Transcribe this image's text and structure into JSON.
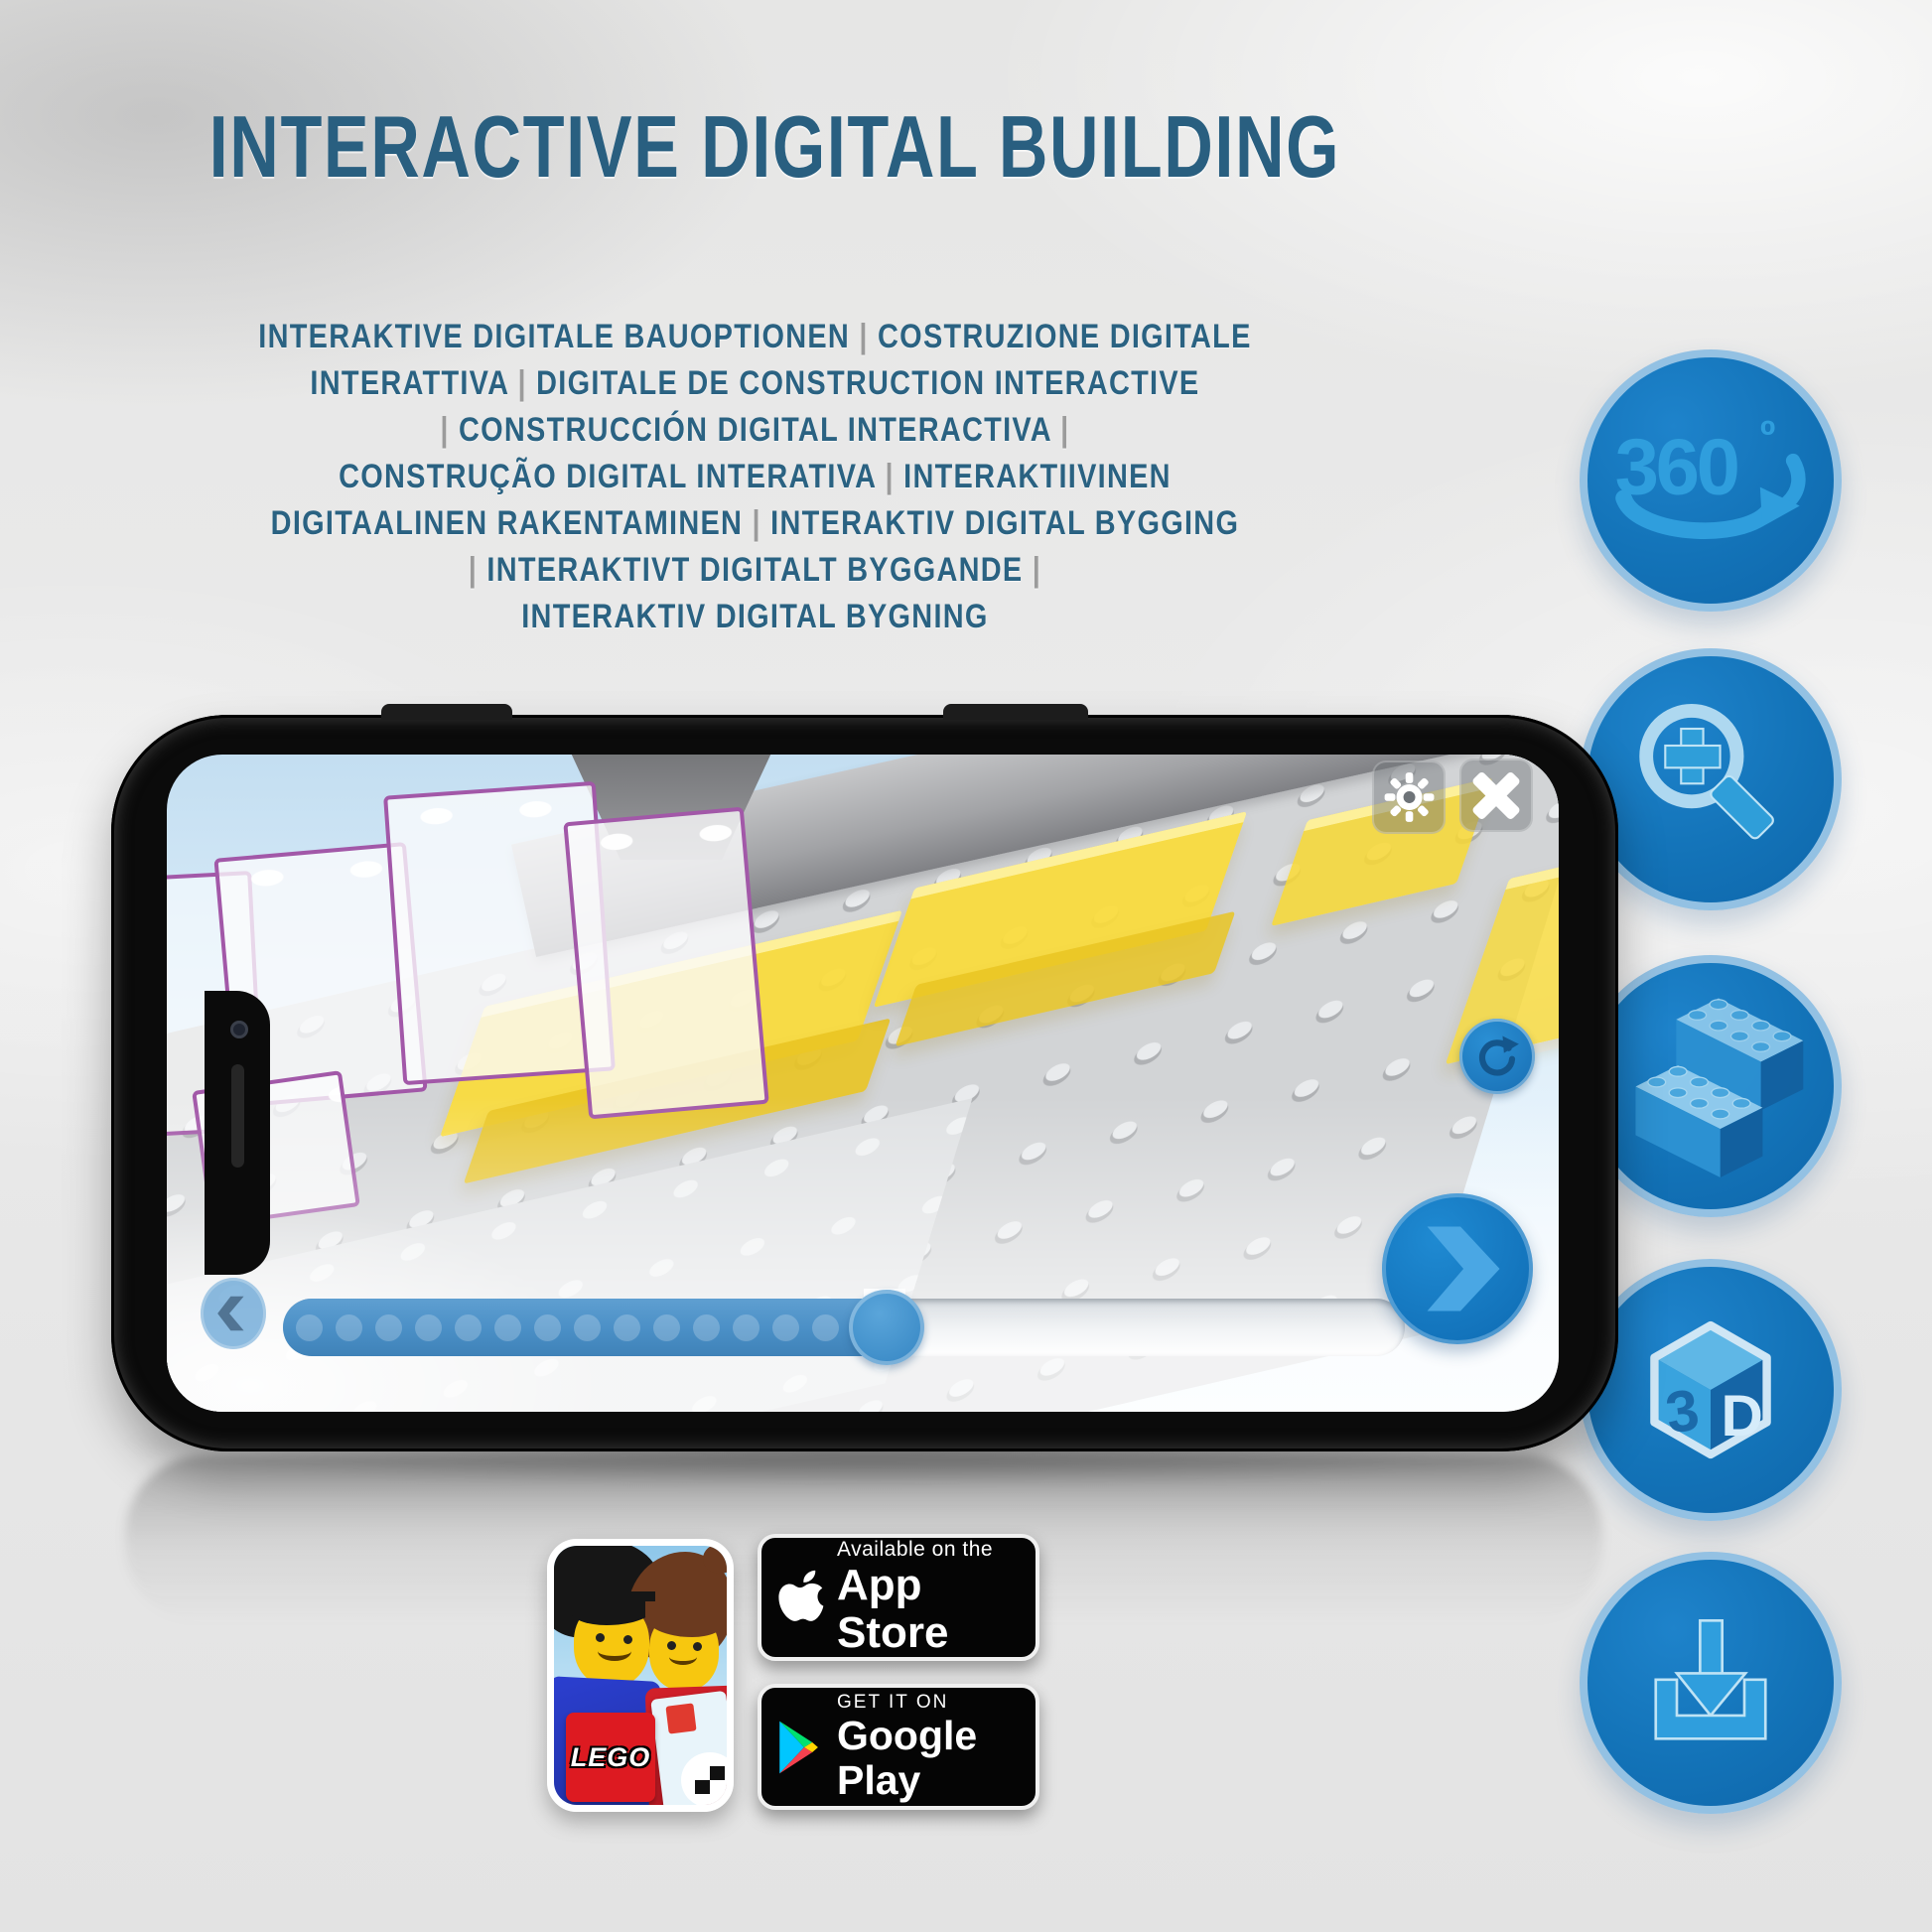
{
  "header": {
    "title": "INTERACTIVE DIGITAL BUILDING"
  },
  "subtitle": {
    "lines": [
      "INTERAKTIVE DIGITALE BAUOPTIONEN | COSTRUZIONE DIGITALE",
      "INTERATTIVA | DIGITALE DE CONSTRUCTION INTERACTIVE",
      "| CONSTRUCCIÓN DIGITAL INTERACTIVA |",
      "CONSTRUÇÃO DIGITAL INTERATIVA | INTERAKTIIVINEN",
      "DIGITAALINEN RAKENTAMINEN | INTERAKTIV DIGITAL BYGGING",
      "| INTERAKTIVT DIGITALT BYGGANDE |",
      "INTERAKTIV DIGITAL BYGNING"
    ]
  },
  "feature_icons": {
    "rotate360": {
      "label": "360",
      "degree_symbol": "º"
    },
    "cube3d": {
      "left_face": "3",
      "right_face": "D"
    }
  },
  "phone": {
    "app_ui": {
      "bookmark_star_glyph": "★"
    },
    "scene": {
      "stud_embossing": "LEGO"
    }
  },
  "store": {
    "app_icon": {
      "lego_logo": "LEGO"
    },
    "app_store": {
      "line1": "Available on the",
      "line2": "App Store"
    },
    "google_play": {
      "line1": "GET IT ON",
      "line2": "Google Play"
    }
  },
  "colors": {
    "title_blue": "#295f80",
    "icon_circle_blue": "#1373b8",
    "icon_circle_border": "#93c1e3",
    "icon_glyph_blue": "#2f9edd",
    "slider_blue": "#4a8fc6",
    "brick_yellow": "#fadb39",
    "brick_outline_purple": "#a258a8",
    "lego_red": "#dd1a21"
  }
}
